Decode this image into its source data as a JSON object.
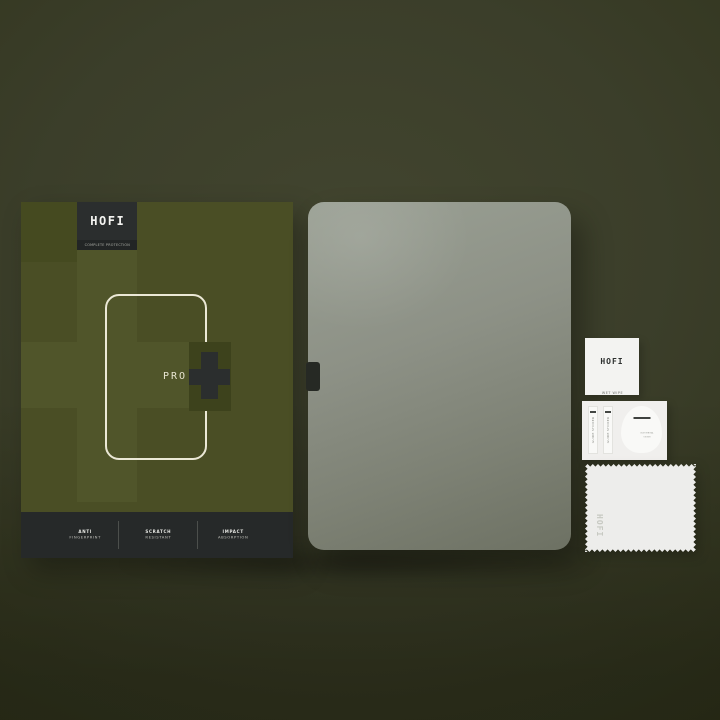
{
  "product": {
    "brand": "HOFI",
    "tagline": "COMPLETE PROTECTION",
    "series_label": "PRO"
  },
  "box": {
    "features": [
      {
        "line1": "ANTI",
        "line2": "FINGERPRINT"
      },
      {
        "line1": "SCRATCH",
        "line2": "RESISTANT"
      },
      {
        "line1": "IMPACT",
        "line2": "ABSORPTION"
      }
    ]
  },
  "accessories": {
    "wet_wipe": {
      "brand": "HOFI",
      "label": "WET WIPE"
    },
    "guide_stickers": [
      {
        "label": "GUIDE STICKER"
      },
      {
        "label": "GUIDE STICKER"
      }
    ],
    "dust_removal": {
      "line1": "DUST REMOVAL",
      "line2": "STICKER"
    },
    "cloth": {
      "brand": "HOFI"
    }
  },
  "colors": {
    "background_olive": "#3b3e2a",
    "box_olive": "#4a4e25",
    "box_olive_light": "#50552a",
    "box_olive_dark": "#3d421c",
    "badge_dark": "#2b2e2e",
    "glass_gray_light": "#9aa094",
    "glass_gray_dark": "#6d7163",
    "accessory_white": "#f3f3f1",
    "outline_cream": "#ebe8d6"
  }
}
